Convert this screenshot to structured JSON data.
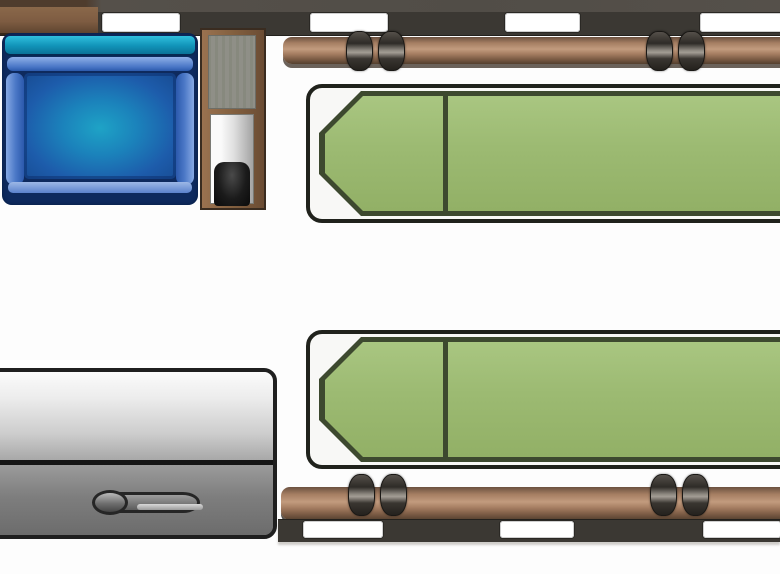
{
  "meta": {
    "title": "Vehicle interior floor plan",
    "view": "top-down schematic, no text labels visible",
    "vehicle_type_hint": "patient-transport / camper style van interior"
  },
  "colors": {
    "floor": "#fdfdfd",
    "wall_dark": "#3b3833",
    "wall_cabinet_brown": "#7e5c42",
    "window_white": "#ffffff",
    "rail_brown": "#c29b7e",
    "rail_shadow": "#54402f",
    "wheel_dark": "#2e2b27",
    "stretcher_frame_black": "#20221c",
    "mattress_green": "#9cba72",
    "mattress_border_olive": "#3d492f",
    "seat_teal": "#1193b8",
    "seat_blue": "#1d5cab",
    "seat_navy": "#0e2a5e",
    "seat_roll_light_blue": "#86a9e4",
    "washstand_brown": "#83603f",
    "counter_gray": "#8f8f87",
    "panel_silver": "#dedede",
    "basin_black": "#1b1b1b",
    "box_light_gray": "#ececec",
    "box_dark_gray": "#6c6c6c",
    "outline_black": "#1f1f1f"
  },
  "components": {
    "top_wall": {
      "label": "top exterior wall with four windows",
      "window_count": 4
    },
    "bottom_wall": {
      "label": "bottom exterior wall with three windows",
      "window_count": 3
    },
    "rail_top": {
      "label": "upper wooden loading rail with two wheel pairs",
      "wheel_pairs": 2
    },
    "rail_bottom": {
      "label": "lower wooden loading rail with two wheel pairs",
      "wheel_pairs": 2
    },
    "stretcher_upper": {
      "label": "upper green stretcher, head end at left",
      "head_end": "left"
    },
    "stretcher_lower": {
      "label": "lower green stretcher, head end at left",
      "head_end": "left"
    },
    "seat": {
      "label": "blue upholstered attendant seat"
    },
    "washstand": {
      "label": "cabinet column with counter, panel and dark basin"
    },
    "storage_box": {
      "label": "gray storage box with door handle"
    },
    "floor": {
      "label": "open white floor area"
    }
  }
}
